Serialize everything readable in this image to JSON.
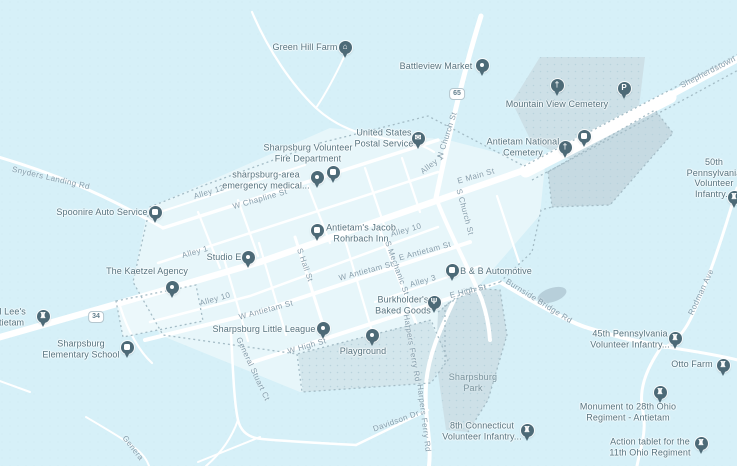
{
  "map": {
    "colors": {
      "background": "#d6f0f8",
      "town_fill": "#e7f6fa",
      "area_fill": "#cde0e7",
      "cemetery_fill": "#c6dae2",
      "playground_fill": "#d3e6ec",
      "pond_fill": "#b7cfda",
      "road": "#ffffff",
      "boundary_dots": "#a4bcc6",
      "pin": "#4d6a77",
      "poi_text": "#55737f",
      "road_text": "#859dab",
      "area_text": "#7b949e"
    },
    "route_shields": [
      {
        "number": "65",
        "x": 457,
        "y": 94
      },
      {
        "number": "34",
        "x": 96,
        "y": 317
      }
    ],
    "pois": [
      {
        "id": "green-hill-farm",
        "label_lines": [
          "Green Hill Farm"
        ],
        "icon": "house",
        "pin": {
          "x": 345,
          "y": 47
        },
        "label": {
          "x": 305,
          "y": 47
        }
      },
      {
        "id": "battleview-market",
        "label_lines": [
          "Battleview Market"
        ],
        "icon": "dot",
        "pin": {
          "x": 482,
          "y": 65
        },
        "label": {
          "x": 436,
          "y": 66
        }
      },
      {
        "id": "us-postal-service",
        "label_lines": [
          "United States",
          "Postal Service"
        ],
        "icon": "mail",
        "pin": {
          "x": 418,
          "y": 138
        },
        "label": {
          "x": 384,
          "y": 138
        }
      },
      {
        "id": "sharpsburg-volunteer-fire-department",
        "label_lines": [
          "Sharpsburg Volunteer",
          "Fire Department"
        ],
        "icon": "square",
        "pin": {
          "x": 333,
          "y": 172
        },
        "label": {
          "x": 308,
          "y": 153
        }
      },
      {
        "id": "sharpsburg-area-emergency-medical",
        "label_lines": [
          "sharpsburg-area",
          "emergency medical..."
        ],
        "icon": "dot",
        "pin": {
          "x": 317,
          "y": 177
        },
        "label": {
          "x": 266,
          "y": 180
        }
      },
      {
        "id": "antietams-jacob-rohrbach-inn",
        "label_lines": [
          "Antietam's Jacob",
          "Rohrbach Inn"
        ],
        "icon": "square",
        "pin": {
          "x": 317,
          "y": 230
        },
        "label": {
          "x": 361,
          "y": 233
        }
      },
      {
        "id": "studio-e",
        "label_lines": [
          "Studio E"
        ],
        "icon": "dot",
        "pin": {
          "x": 248,
          "y": 257
        },
        "label": {
          "x": 224,
          "y": 257
        }
      },
      {
        "id": "the-kaetzel-agency",
        "label_lines": [
          "The Kaetzel Agency"
        ],
        "icon": "dot",
        "pin": {
          "x": 172,
          "y": 287
        },
        "label": {
          "x": 147,
          "y": 271
        }
      },
      {
        "id": "spoonire-auto-service",
        "label_lines": [
          "Spoonire Auto Service"
        ],
        "icon": "square",
        "pin": {
          "x": 155,
          "y": 212
        },
        "label": {
          "x": 102,
          "y": 212
        }
      },
      {
        "id": "b-and-b-automotive",
        "label_lines": [
          "B & B Automotive"
        ],
        "icon": "square",
        "pin": {
          "x": 452,
          "y": 270
        },
        "label": {
          "x": 496,
          "y": 271
        }
      },
      {
        "id": "burkholders-baked-goods",
        "label_lines": [
          "Burkholder's",
          "Baked Goods"
        ],
        "icon": "fork",
        "pin": {
          "x": 434,
          "y": 302
        },
        "label": {
          "x": 403,
          "y": 305
        }
      },
      {
        "id": "sharpsburg-little-league",
        "label_lines": [
          "Sharpsburg Little League"
        ],
        "icon": "dot",
        "pin": {
          "x": 323,
          "y": 328
        },
        "label": {
          "x": 264,
          "y": 329
        }
      },
      {
        "id": "playground",
        "label_lines": [
          "Playground"
        ],
        "icon": "dot",
        "pin": {
          "x": 372,
          "y": 335
        },
        "label": {
          "x": 363,
          "y": 351
        }
      },
      {
        "id": "sharpsburg-elementary-school",
        "label_lines": [
          "Sharpsburg",
          "Elementary School"
        ],
        "icon": "square",
        "pin": {
          "x": 127,
          "y": 347
        },
        "label": {
          "x": 81,
          "y": 349
        }
      },
      {
        "id": "general-lees-antietam",
        "label_lines": [
          "eral Lee's",
          "Antietam"
        ],
        "icon": "rook",
        "pin": {
          "x": 43,
          "y": 316
        },
        "label": {
          "x": 6,
          "y": 317
        }
      },
      {
        "id": "mountain-view-cemetery",
        "label_lines": [
          "Mountain View Cemetery"
        ],
        "icon": "grave",
        "pin": {
          "x": 557,
          "y": 85
        },
        "label": {
          "x": 557,
          "y": 104
        }
      },
      {
        "id": "antietam-national-cemetery",
        "label_lines": [
          "Antietam National",
          "Cemetery"
        ],
        "icon": "grave",
        "pin": {
          "x": 565,
          "y": 147
        },
        "label": {
          "x": 523,
          "y": 147
        }
      },
      {
        "id": "cemetery-info",
        "label_lines": [],
        "icon": "square",
        "pin": {
          "x": 584,
          "y": 136
        },
        "label": null
      },
      {
        "id": "parking",
        "label_lines": [],
        "icon": "p",
        "pin": {
          "x": 624,
          "y": 88
        },
        "label": null
      },
      {
        "id": "50th-pennsylvania-volunteer-infantry",
        "label_lines": [
          "50th Pennsylvania",
          "Volunteer Infantry..."
        ],
        "icon": "rook",
        "pin": {
          "x": 734,
          "y": 197
        },
        "label": {
          "x": 714,
          "y": 178
        }
      },
      {
        "id": "45th-pennsylvania-volunteer-infantry",
        "label_lines": [
          "45th Pennsylvania",
          "Volunteer Infantry..."
        ],
        "icon": "rook",
        "pin": {
          "x": 675,
          "y": 338
        },
        "label": {
          "x": 630,
          "y": 339
        }
      },
      {
        "id": "otto-farm",
        "label_lines": [
          "Otto Farm"
        ],
        "icon": "rook",
        "pin": {
          "x": 723,
          "y": 365
        },
        "label": {
          "x": 692,
          "y": 364
        }
      },
      {
        "id": "monument-28th-ohio-regiment",
        "label_lines": [
          "Monument to 28th Ohio",
          "Regiment - Antietam"
        ],
        "icon": "rook",
        "pin": {
          "x": 660,
          "y": 392
        },
        "label": {
          "x": 628,
          "y": 412
        }
      },
      {
        "id": "action-tablet-11th-ohio-regiment",
        "label_lines": [
          "Action tablet for the",
          "11th Ohio Regiment"
        ],
        "icon": "rook",
        "pin": {
          "x": 701,
          "y": 443
        },
        "label": {
          "x": 650,
          "y": 447
        }
      },
      {
        "id": "8th-connecticut-volunteer-infantry",
        "label_lines": [
          "8th Connecticut",
          "Volunteer Infantry..."
        ],
        "icon": "rook",
        "pin": {
          "x": 527,
          "y": 430
        },
        "label": {
          "x": 482,
          "y": 431
        }
      }
    ],
    "area_labels": [
      {
        "id": "sharpsburg-park",
        "lines": [
          "Sharpsburg",
          "Park"
        ],
        "x": 473,
        "y": 383
      }
    ],
    "road_labels": [
      {
        "text": "Shepherdstown",
        "x": 708,
        "y": 72,
        "rot": -27
      },
      {
        "text": "Snyders Landing Rd",
        "x": 51,
        "y": 178,
        "rot": 13
      },
      {
        "text": "N Church St",
        "x": 447,
        "y": 135,
        "rot": -72
      },
      {
        "text": "S Church St",
        "x": 465,
        "y": 212,
        "rot": 75
      },
      {
        "text": "E Main St",
        "x": 476,
        "y": 176,
        "rot": -16
      },
      {
        "text": "W Chapline St",
        "x": 260,
        "y": 199,
        "rot": -16
      },
      {
        "text": "Alley 12",
        "x": 209,
        "y": 192,
        "rot": -17
      },
      {
        "text": "Alley 1",
        "x": 195,
        "y": 252,
        "rot": -16
      },
      {
        "text": "Alley 1",
        "x": 432,
        "y": 164,
        "rot": -38
      },
      {
        "text": "Alley 10",
        "x": 215,
        "y": 299,
        "rot": -16
      },
      {
        "text": "Alley 10",
        "x": 406,
        "y": 230,
        "rot": -16
      },
      {
        "text": "Alley 3",
        "x": 423,
        "y": 281,
        "rot": -16
      },
      {
        "text": "W Antietam St",
        "x": 266,
        "y": 310,
        "rot": -15
      },
      {
        "text": "W Antietam St",
        "x": 366,
        "y": 271,
        "rot": -15
      },
      {
        "text": "E Antietam St",
        "x": 425,
        "y": 251,
        "rot": -15
      },
      {
        "text": "S Hall St",
        "x": 305,
        "y": 265,
        "rot": 71
      },
      {
        "text": "S Mechanic St",
        "x": 397,
        "y": 268,
        "rot": 70
      },
      {
        "text": "W High St",
        "x": 307,
        "y": 346,
        "rot": -16
      },
      {
        "text": "E High St",
        "x": 468,
        "y": 291,
        "rot": -14
      },
      {
        "text": "General Stuart Ct",
        "x": 253,
        "y": 369,
        "rot": 65
      },
      {
        "text": "Genera",
        "x": 133,
        "y": 448,
        "rot": 52
      },
      {
        "text": "Davidson Dr",
        "x": 396,
        "y": 421,
        "rot": -20
      },
      {
        "text": "Harpers Ferry Rd",
        "x": 412,
        "y": 348,
        "rot": 80
      },
      {
        "text": "Harpers Ferry Rd",
        "x": 424,
        "y": 418,
        "rot": 83
      },
      {
        "text": "Burnside Bridge Rd",
        "x": 539,
        "y": 301,
        "rot": 32
      },
      {
        "text": "Rodman Ave",
        "x": 701,
        "y": 292,
        "rot": -65
      }
    ]
  }
}
